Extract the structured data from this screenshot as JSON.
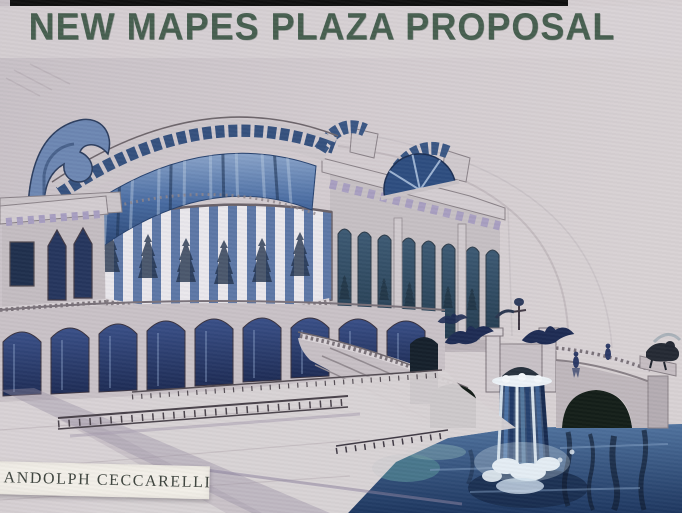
{
  "artwork": {
    "title": "NEW MAPES PLAZA PROPOSAL",
    "artist_signature": "ANDOLPH CECCARELLI"
  },
  "scene_elements": [
    "curved-glass-crown",
    "scroll-volute-parapet",
    "striped-colonnade-band",
    "gothic-arch-windows",
    "tall-arched-windows",
    "ground-arcade",
    "grand-staircase",
    "stone-bridge",
    "waterfall",
    "river-water",
    "eagle-sculptures",
    "longhorn-bull-sculpture",
    "plaza-railings"
  ],
  "colors": {
    "paper": "#cfc8cd",
    "paper_light": "#d8d2d4",
    "title_green": "#3d5747",
    "film_edge_black": "#101010",
    "stone": "#c6c0c4",
    "pencil_gray": "#6e666c",
    "glass_blue": "#476aa0",
    "window_navy": "#26365e",
    "window_teal": "#3d5a74",
    "frieze_lavender": "#a79ec1",
    "water_blue": "#50739f",
    "water_dark": "#1e3760",
    "water_teal": "#4c7d8e",
    "foam_white": "#e9f0f6",
    "sculpture_navy": "#1e2c54",
    "arch_shadow": "#141f19",
    "card_white": "#f2efe8",
    "card_text": "#3e443e"
  }
}
